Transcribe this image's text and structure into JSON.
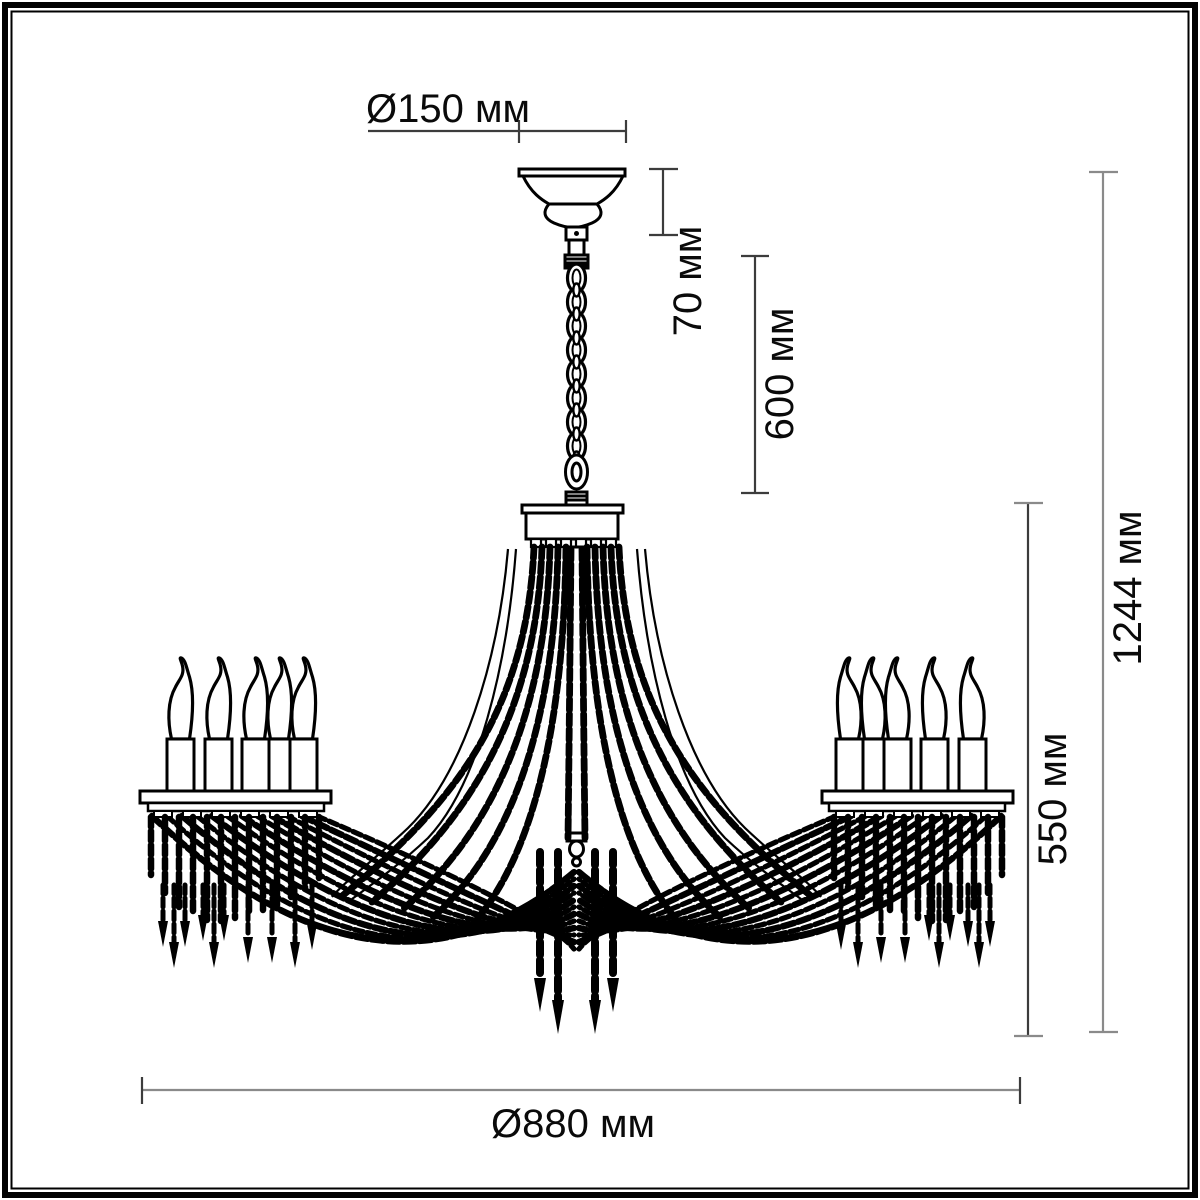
{
  "diagram": {
    "colors": {
      "ink": "#000000",
      "dimension_line_gray": "#8a8a8a",
      "dimension_line_dark": "#3c3c3c",
      "label_text": "#0a0a0a",
      "background": "#ffffff"
    },
    "dimensions": {
      "canopy_diameter": "Ø150 мм",
      "canopy_height": "70 мм",
      "chain_length": "600 мм",
      "total_height": "1244 мм",
      "body_height": "550 мм",
      "body_diameter": "Ø880 мм"
    }
  }
}
